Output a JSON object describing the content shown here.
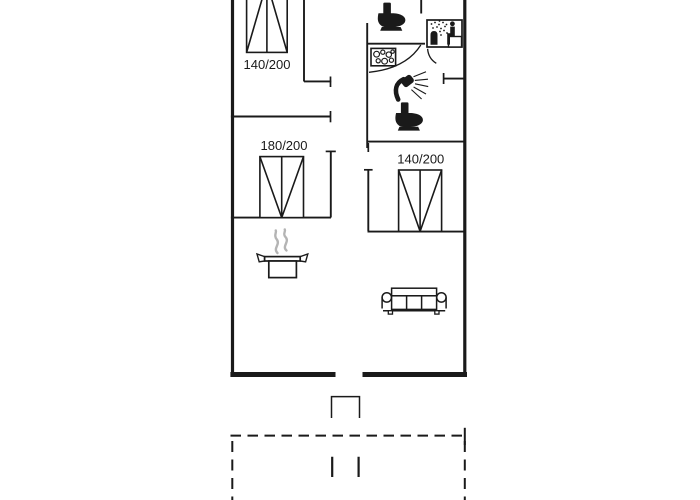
{
  "page": {
    "background": "#ffffff"
  },
  "floorplan": {
    "type": "vacation-house-floor-plan",
    "line_color": "#1a1a1a",
    "steam_color": "#b4b4b4",
    "labels": {
      "bed_top_left": "140/200",
      "bed_mid_left": "180/200",
      "bed_mid_right": "140/200"
    },
    "icons": [
      "double-bed-icon",
      "double-bed-icon",
      "double-bed-icon",
      "toilet-icon",
      "toilet-icon",
      "washbasin-icon",
      "shower-icon",
      "sauna-icon",
      "cooking-pot-icon",
      "steam-icon",
      "sofa-icon",
      "entrance-steps",
      "terrace-dashed-outline"
    ]
  }
}
